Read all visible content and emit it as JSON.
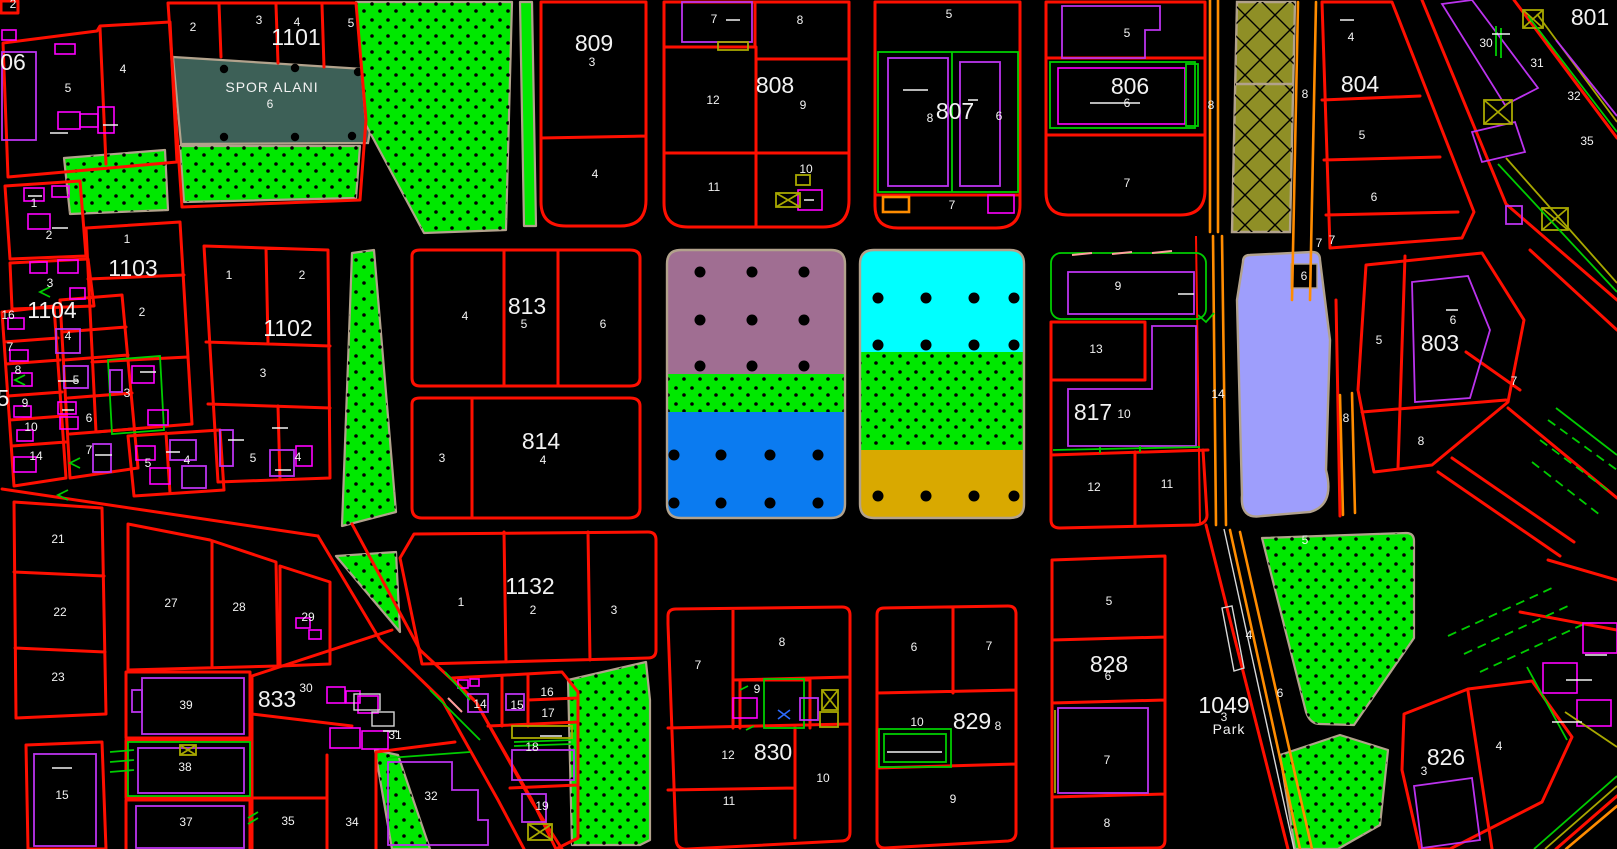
{
  "app": {
    "description_label": "cadastral zoning map canvas"
  },
  "colors": {
    "background": "#000000",
    "red": "#ff0f00",
    "orange": "#ff8c00",
    "magenta": "#ff00ff",
    "violet": "#bb33ee",
    "green": "#00e800",
    "green2": "#00cc00",
    "olive": "#a8a800",
    "olive_zone": "#8f8f26",
    "teal": "#3d6057",
    "mauve": "#a06e92",
    "cyan": "#00ffff",
    "blue": "#0b7bf0",
    "gold": "#d9a900",
    "lavender": "#9e9efc",
    "tan": "#b2a28c",
    "white": "#f2f2f2",
    "gray": "#d8d8d8",
    "salmon": "#ff9e9e",
    "blue2": "#2d6bff"
  },
  "zones": [
    {
      "name": "sports-area",
      "color_key": "teal"
    },
    {
      "name": "park-stipple",
      "color_key": "green"
    },
    {
      "name": "residential-mauve",
      "color_key": "mauve"
    },
    {
      "name": "residential-cyan",
      "color_key": "cyan"
    },
    {
      "name": "residential-blue",
      "color_key": "blue"
    },
    {
      "name": "residential-gold",
      "color_key": "gold"
    },
    {
      "name": "special-lavender",
      "color_key": "lavender"
    },
    {
      "name": "road-reserve-hatch",
      "color_key": "olive_zone"
    }
  ],
  "labels": [
    {
      "t": "06",
      "x": 13,
      "y": 62,
      "k": "b"
    },
    {
      "t": "1101",
      "x": 296,
      "y": 37,
      "k": "b"
    },
    {
      "t": "809",
      "x": 594,
      "y": 43,
      "k": "b"
    },
    {
      "t": "808",
      "x": 775,
      "y": 85,
      "k": "b"
    },
    {
      "t": "807",
      "x": 955,
      "y": 111,
      "k": "b"
    },
    {
      "t": "806",
      "x": 1130,
      "y": 86,
      "k": "b"
    },
    {
      "t": "804",
      "x": 1360,
      "y": 84,
      "k": "b"
    },
    {
      "t": "801",
      "x": 1590,
      "y": 17,
      "k": "b"
    },
    {
      "t": "5",
      "x": 3,
      "y": 398,
      "k": "b"
    },
    {
      "t": "1104",
      "x": 52,
      "y": 310,
      "k": "b"
    },
    {
      "t": "1103",
      "x": 133,
      "y": 268,
      "k": "b"
    },
    {
      "t": "1102",
      "x": 288,
      "y": 328,
      "k": "b"
    },
    {
      "t": "813",
      "x": 527,
      "y": 306,
      "k": "b"
    },
    {
      "t": "814",
      "x": 541,
      "y": 441,
      "k": "b"
    },
    {
      "t": "817",
      "x": 1093,
      "y": 412,
      "k": "b"
    },
    {
      "t": "803",
      "x": 1440,
      "y": 343,
      "k": "b"
    },
    {
      "t": "1132",
      "x": 530,
      "y": 586,
      "k": "b"
    },
    {
      "t": "833",
      "x": 277,
      "y": 699,
      "k": "b"
    },
    {
      "t": "828",
      "x": 1109,
      "y": 664,
      "k": "b"
    },
    {
      "t": "829",
      "x": 972,
      "y": 721,
      "k": "b"
    },
    {
      "t": "830",
      "x": 773,
      "y": 752,
      "k": "b"
    },
    {
      "t": "826",
      "x": 1446,
      "y": 757,
      "k": "b"
    },
    {
      "t": "1049",
      "x": 1224,
      "y": 705,
      "k": "b"
    },
    {
      "t": "SPOR ALANI",
      "x": 272,
      "y": 87,
      "k": "z"
    },
    {
      "t": "Park",
      "x": 1229,
      "y": 729,
      "k": "z"
    },
    {
      "t": "2",
      "x": 13,
      "y": 4,
      "k": "p"
    },
    {
      "t": "2",
      "x": 193,
      "y": 27,
      "k": "p"
    },
    {
      "t": "3",
      "x": 259,
      "y": 20,
      "k": "p"
    },
    {
      "t": "4",
      "x": 297,
      "y": 22,
      "k": "p"
    },
    {
      "t": "5",
      "x": 351,
      "y": 23,
      "k": "p"
    },
    {
      "t": "6",
      "x": 270,
      "y": 104,
      "k": "p"
    },
    {
      "t": "5",
      "x": 68,
      "y": 88,
      "k": "p"
    },
    {
      "t": "4",
      "x": 123,
      "y": 69,
      "k": "p"
    },
    {
      "t": "1",
      "x": 34,
      "y": 203,
      "k": "p"
    },
    {
      "t": "2",
      "x": 49,
      "y": 235,
      "k": "p"
    },
    {
      "t": "3",
      "x": 592,
      "y": 62,
      "k": "p"
    },
    {
      "t": "4",
      "x": 595,
      "y": 174,
      "k": "p"
    },
    {
      "t": "7",
      "x": 714,
      "y": 19,
      "k": "p"
    },
    {
      "t": "8",
      "x": 800,
      "y": 20,
      "k": "p"
    },
    {
      "t": "12",
      "x": 713,
      "y": 100,
      "k": "p"
    },
    {
      "t": "9",
      "x": 803,
      "y": 105,
      "k": "p"
    },
    {
      "t": "11",
      "x": 714,
      "y": 187,
      "k": "p"
    },
    {
      "t": "10",
      "x": 806,
      "y": 169,
      "k": "p"
    },
    {
      "t": "5",
      "x": 949,
      "y": 14,
      "k": "p"
    },
    {
      "t": "8",
      "x": 930,
      "y": 118,
      "k": "p"
    },
    {
      "t": "6",
      "x": 999,
      "y": 116,
      "k": "p"
    },
    {
      "t": "7",
      "x": 952,
      "y": 205,
      "k": "p"
    },
    {
      "t": "5",
      "x": 1127,
      "y": 33,
      "k": "p"
    },
    {
      "t": "6",
      "x": 1127,
      "y": 103,
      "k": "p"
    },
    {
      "t": "7",
      "x": 1127,
      "y": 183,
      "k": "p"
    },
    {
      "t": "8",
      "x": 1211,
      "y": 105,
      "k": "p"
    },
    {
      "t": "8",
      "x": 1305,
      "y": 94,
      "k": "p"
    },
    {
      "t": "4",
      "x": 1351,
      "y": 37,
      "k": "p"
    },
    {
      "t": "5",
      "x": 1362,
      "y": 135,
      "k": "p"
    },
    {
      "t": "6",
      "x": 1374,
      "y": 197,
      "k": "p"
    },
    {
      "t": "7",
      "x": 1332,
      "y": 240,
      "k": "p"
    },
    {
      "t": "30",
      "x": 1486,
      "y": 43,
      "k": "p"
    },
    {
      "t": "31",
      "x": 1537,
      "y": 63,
      "k": "p"
    },
    {
      "t": "32",
      "x": 1574,
      "y": 96,
      "k": "p"
    },
    {
      "t": "35",
      "x": 1587,
      "y": 141,
      "k": "p"
    },
    {
      "t": "1",
      "x": 127,
      "y": 239,
      "k": "p"
    },
    {
      "t": "2",
      "x": 142,
      "y": 312,
      "k": "p"
    },
    {
      "t": "3",
      "x": 127,
      "y": 393,
      "k": "p"
    },
    {
      "t": "16",
      "x": 8,
      "y": 315,
      "k": "p"
    },
    {
      "t": "7",
      "x": 10,
      "y": 347,
      "k": "p"
    },
    {
      "t": "8",
      "x": 18,
      "y": 370,
      "k": "p"
    },
    {
      "t": "9",
      "x": 25,
      "y": 403,
      "k": "p"
    },
    {
      "t": "10",
      "x": 31,
      "y": 427,
      "k": "p"
    },
    {
      "t": "14",
      "x": 36,
      "y": 456,
      "k": "p"
    },
    {
      "t": "3",
      "x": 50,
      "y": 283,
      "k": "p"
    },
    {
      "t": "4",
      "x": 68,
      "y": 336,
      "k": "p"
    },
    {
      "t": "5",
      "x": 76,
      "y": 380,
      "k": "p"
    },
    {
      "t": "6",
      "x": 89,
      "y": 418,
      "k": "p"
    },
    {
      "t": "7",
      "x": 89,
      "y": 450,
      "k": "p"
    },
    {
      "t": "5",
      "x": 148,
      "y": 463,
      "k": "p"
    },
    {
      "t": "4",
      "x": 187,
      "y": 460,
      "k": "p"
    },
    {
      "t": "1",
      "x": 229,
      "y": 275,
      "k": "p"
    },
    {
      "t": "2",
      "x": 302,
      "y": 275,
      "k": "p"
    },
    {
      "t": "3",
      "x": 263,
      "y": 373,
      "k": "p"
    },
    {
      "t": "5",
      "x": 253,
      "y": 458,
      "k": "p"
    },
    {
      "t": "4",
      "x": 298,
      "y": 457,
      "k": "p"
    },
    {
      "t": "4",
      "x": 465,
      "y": 316,
      "k": "p"
    },
    {
      "t": "5",
      "x": 524,
      "y": 324,
      "k": "p"
    },
    {
      "t": "6",
      "x": 603,
      "y": 324,
      "k": "p"
    },
    {
      "t": "3",
      "x": 442,
      "y": 458,
      "k": "p"
    },
    {
      "t": "4",
      "x": 543,
      "y": 460,
      "k": "p"
    },
    {
      "t": "9",
      "x": 1118,
      "y": 286,
      "k": "p"
    },
    {
      "t": "13",
      "x": 1096,
      "y": 349,
      "k": "p"
    },
    {
      "t": "10",
      "x": 1124,
      "y": 414,
      "k": "p"
    },
    {
      "t": "12",
      "x": 1094,
      "y": 487,
      "k": "p"
    },
    {
      "t": "11",
      "x": 1167,
      "y": 484,
      "k": "p"
    },
    {
      "t": "14",
      "x": 1218,
      "y": 394,
      "k": "p"
    },
    {
      "t": "6",
      "x": 1304,
      "y": 276,
      "k": "p"
    },
    {
      "t": "7",
      "x": 1319,
      "y": 243,
      "k": "p"
    },
    {
      "t": "5",
      "x": 1379,
      "y": 340,
      "k": "p"
    },
    {
      "t": "6",
      "x": 1453,
      "y": 320,
      "k": "p"
    },
    {
      "t": "7",
      "x": 1514,
      "y": 381,
      "k": "p"
    },
    {
      "t": "8",
      "x": 1421,
      "y": 441,
      "k": "p"
    },
    {
      "t": "8",
      "x": 1346,
      "y": 418,
      "k": "p"
    },
    {
      "t": "5",
      "x": 1305,
      "y": 540,
      "k": "p"
    },
    {
      "t": "4",
      "x": 1249,
      "y": 635,
      "k": "p"
    },
    {
      "t": "6",
      "x": 1280,
      "y": 693,
      "k": "p"
    },
    {
      "t": "3",
      "x": 1224,
      "y": 717,
      "k": "p"
    },
    {
      "t": "21",
      "x": 58,
      "y": 539,
      "k": "p"
    },
    {
      "t": "22",
      "x": 60,
      "y": 612,
      "k": "p"
    },
    {
      "t": "23",
      "x": 58,
      "y": 677,
      "k": "p"
    },
    {
      "t": "15",
      "x": 62,
      "y": 795,
      "k": "p"
    },
    {
      "t": "27",
      "x": 171,
      "y": 603,
      "k": "p"
    },
    {
      "t": "28",
      "x": 239,
      "y": 607,
      "k": "p"
    },
    {
      "t": "29",
      "x": 308,
      "y": 617,
      "k": "p"
    },
    {
      "t": "30",
      "x": 306,
      "y": 688,
      "k": "p"
    },
    {
      "t": "39",
      "x": 186,
      "y": 705,
      "k": "p"
    },
    {
      "t": "38",
      "x": 185,
      "y": 767,
      "k": "p"
    },
    {
      "t": "37",
      "x": 186,
      "y": 822,
      "k": "p"
    },
    {
      "t": "35",
      "x": 288,
      "y": 821,
      "k": "p"
    },
    {
      "t": "34",
      "x": 352,
      "y": 822,
      "k": "p"
    },
    {
      "t": "31",
      "x": 395,
      "y": 735,
      "k": "p"
    },
    {
      "t": "32",
      "x": 431,
      "y": 796,
      "k": "p"
    },
    {
      "t": "1",
      "x": 461,
      "y": 602,
      "k": "p"
    },
    {
      "t": "2",
      "x": 533,
      "y": 610,
      "k": "p"
    },
    {
      "t": "3",
      "x": 614,
      "y": 610,
      "k": "p"
    },
    {
      "t": "14",
      "x": 480,
      "y": 704,
      "k": "p"
    },
    {
      "t": "15",
      "x": 517,
      "y": 705,
      "k": "p"
    },
    {
      "t": "16",
      "x": 547,
      "y": 692,
      "k": "p"
    },
    {
      "t": "17",
      "x": 548,
      "y": 713,
      "k": "p"
    },
    {
      "t": "18",
      "x": 532,
      "y": 747,
      "k": "p"
    },
    {
      "t": "19",
      "x": 542,
      "y": 806,
      "k": "p"
    },
    {
      "t": "7",
      "x": 698,
      "y": 665,
      "k": "p"
    },
    {
      "t": "8",
      "x": 782,
      "y": 642,
      "k": "p"
    },
    {
      "t": "9",
      "x": 757,
      "y": 689,
      "k": "p"
    },
    {
      "t": "12",
      "x": 728,
      "y": 755,
      "k": "p"
    },
    {
      "t": "10",
      "x": 823,
      "y": 778,
      "k": "p"
    },
    {
      "t": "11",
      "x": 729,
      "y": 801,
      "k": "p"
    },
    {
      "t": "6",
      "x": 914,
      "y": 647,
      "k": "p"
    },
    {
      "t": "7",
      "x": 989,
      "y": 646,
      "k": "p"
    },
    {
      "t": "10",
      "x": 917,
      "y": 722,
      "k": "p"
    },
    {
      "t": "8",
      "x": 998,
      "y": 726,
      "k": "p"
    },
    {
      "t": "9",
      "x": 953,
      "y": 799,
      "k": "p"
    },
    {
      "t": "5",
      "x": 1109,
      "y": 601,
      "k": "p"
    },
    {
      "t": "6",
      "x": 1108,
      "y": 676,
      "k": "p"
    },
    {
      "t": "7",
      "x": 1107,
      "y": 760,
      "k": "p"
    },
    {
      "t": "8",
      "x": 1107,
      "y": 823,
      "k": "p"
    },
    {
      "t": "3",
      "x": 1424,
      "y": 771,
      "k": "p"
    },
    {
      "t": "4",
      "x": 1499,
      "y": 746,
      "k": "p"
    }
  ]
}
